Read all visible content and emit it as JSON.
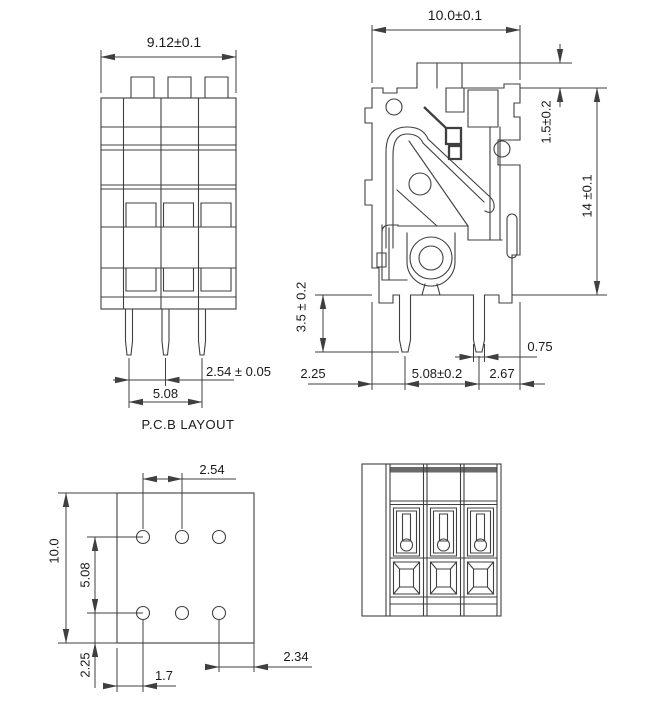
{
  "drawing": {
    "title": "P.C.B LAYOUT",
    "front_view": {
      "width": "9.12±0.1",
      "pin_pitch": "2.54 ± 0.05",
      "pin_span": "5.08"
    },
    "side_view": {
      "width": "10.0±0.1",
      "lever_height": "1.5±0.2",
      "height": "14 ±0.1",
      "pin_length": "3.5 ± 0.2",
      "left_offset": "2.25",
      "pin_pitch": "5.08±0.2",
      "right_offset": "2.67",
      "pin_width": "0.75"
    },
    "pcb_layout": {
      "hole_pitch_x": "2.54",
      "board_height": "10.0",
      "row_pitch": "5.08",
      "bottom_offset": "2.25",
      "left_offset": "1.7",
      "right_offset": "2.34"
    },
    "colors": {
      "line": "#3f3f3f",
      "text": "#1a1a1a",
      "band": "#6a6a6a",
      "background": "#ffffff"
    }
  }
}
